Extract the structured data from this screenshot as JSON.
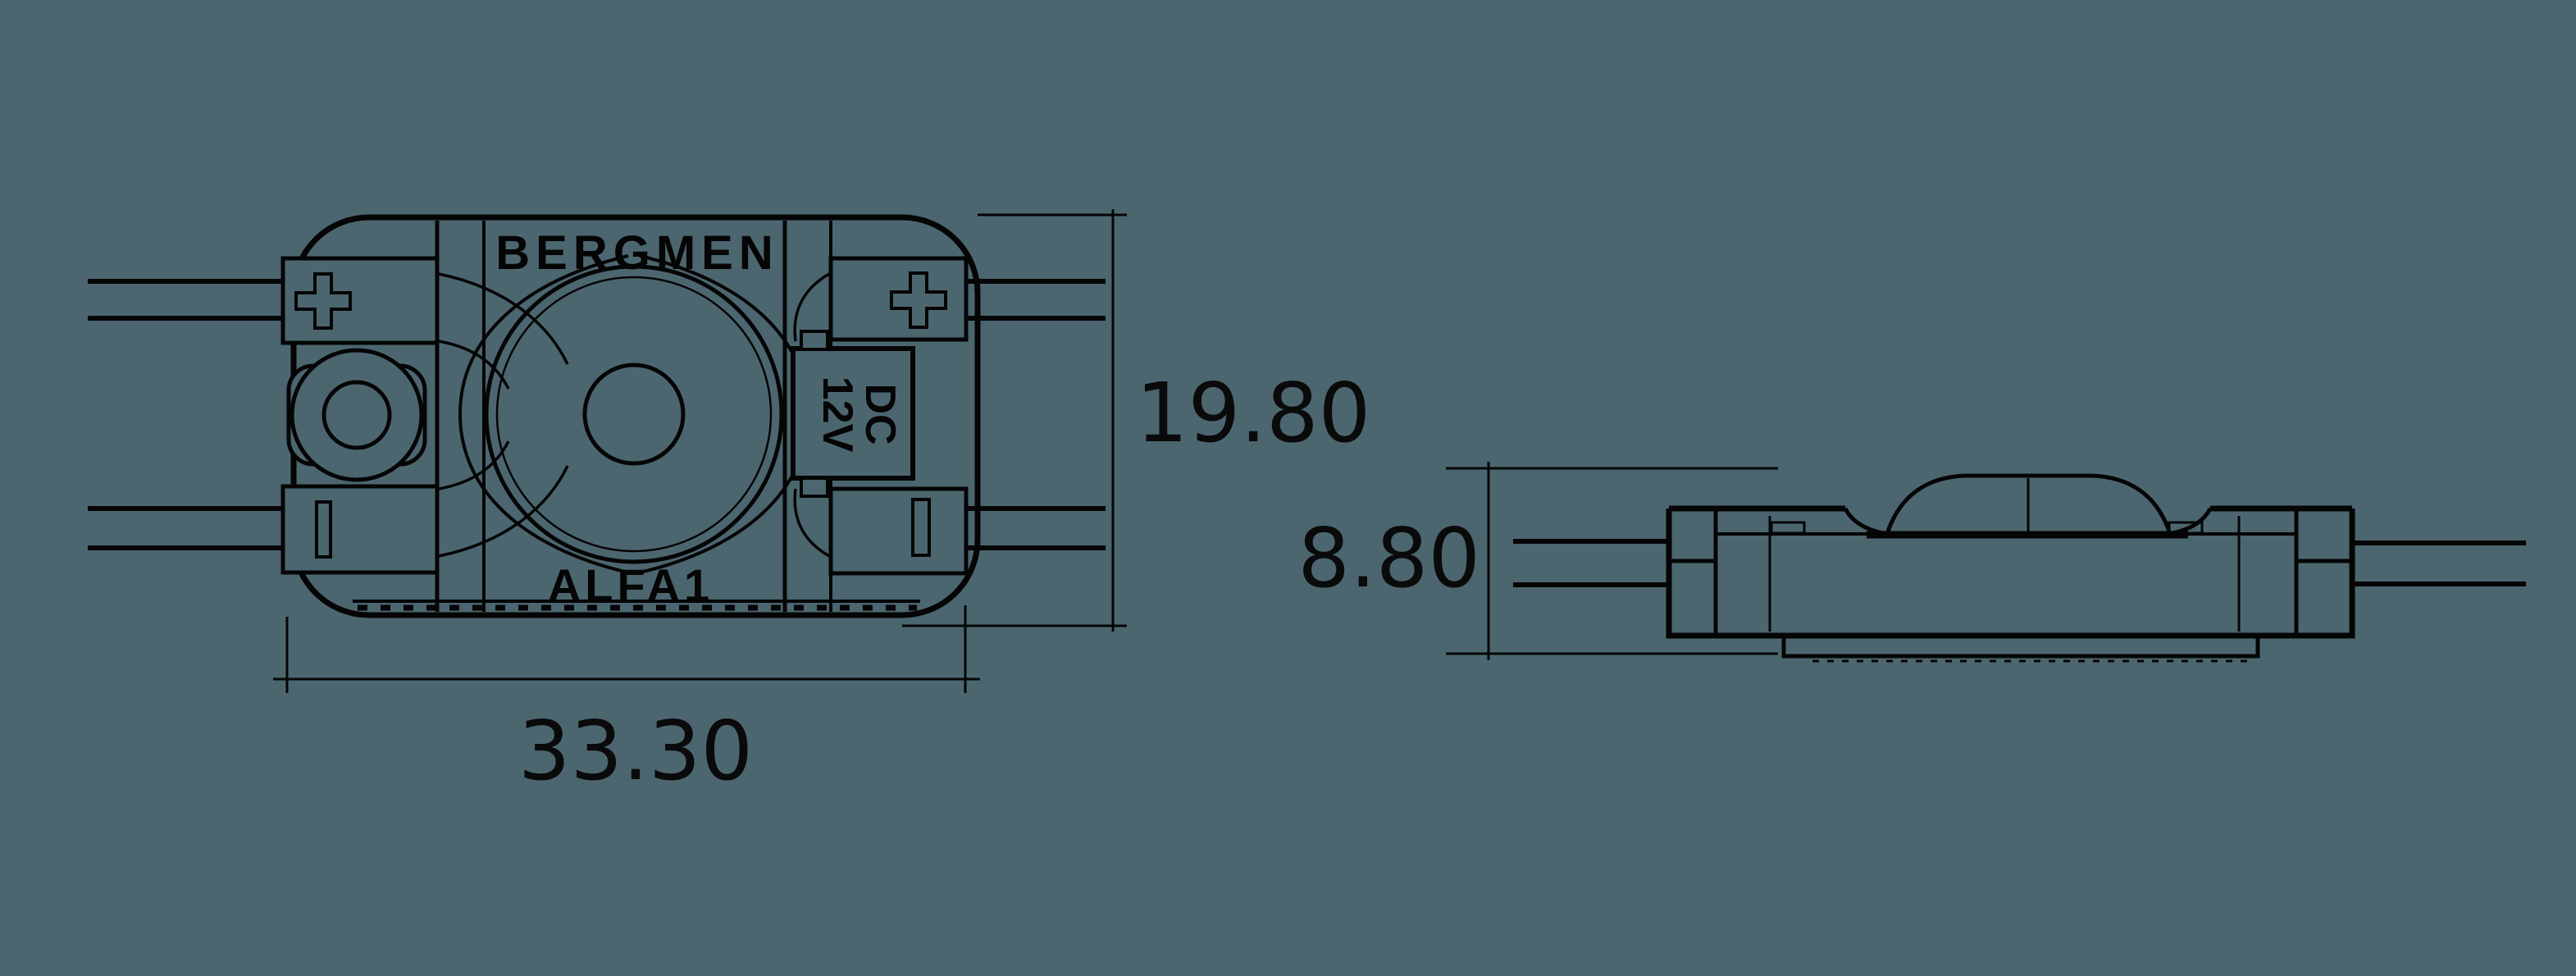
{
  "page": {
    "background_color": "#4c6670",
    "line_color": "#050505"
  },
  "top_view": {
    "brand": "BERGMEN",
    "model": "ALFA1",
    "terminal_plus": "+",
    "supply_marking_line1": "DC",
    "supply_marking_line2": "12V",
    "width_dimension": "33.30",
    "height_dimension": "19.80"
  },
  "side_view": {
    "depth_dimension": "8.80"
  }
}
